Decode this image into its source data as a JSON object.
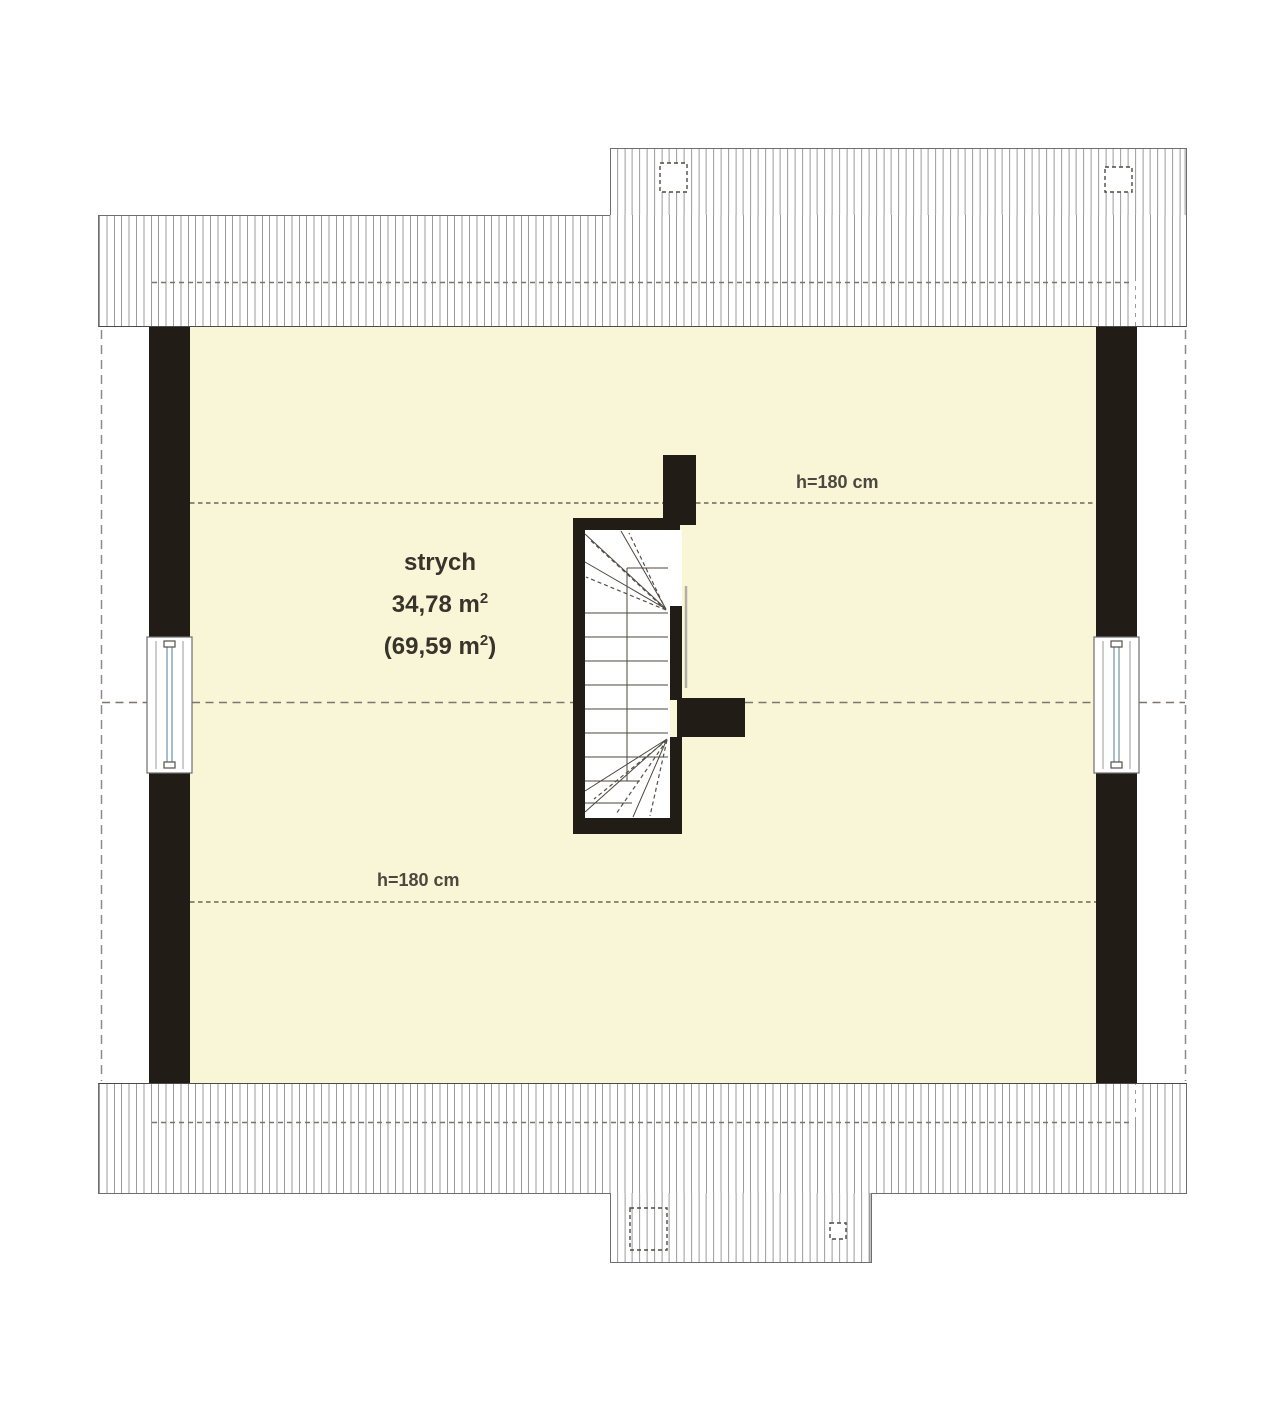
{
  "room": {
    "name": "strych",
    "area": {
      "pre": "34,78 m",
      "sup": "2",
      "post": ""
    },
    "area_total": {
      "pre": "(69,59 m",
      "sup": "2",
      "post": ")"
    }
  },
  "height_labels": [
    {
      "text": "h=180 cm"
    },
    {
      "text": "h=180 cm"
    }
  ],
  "colors": {
    "wall": "#211c16",
    "floor_fill": "#f8f6d7",
    "hatch_line": "#9b9b9b",
    "roof_outline": "#6e6e6e",
    "dashed_line": "#6b655b",
    "window_glazing": "#a6bfcb",
    "label_text": "#38332b"
  }
}
